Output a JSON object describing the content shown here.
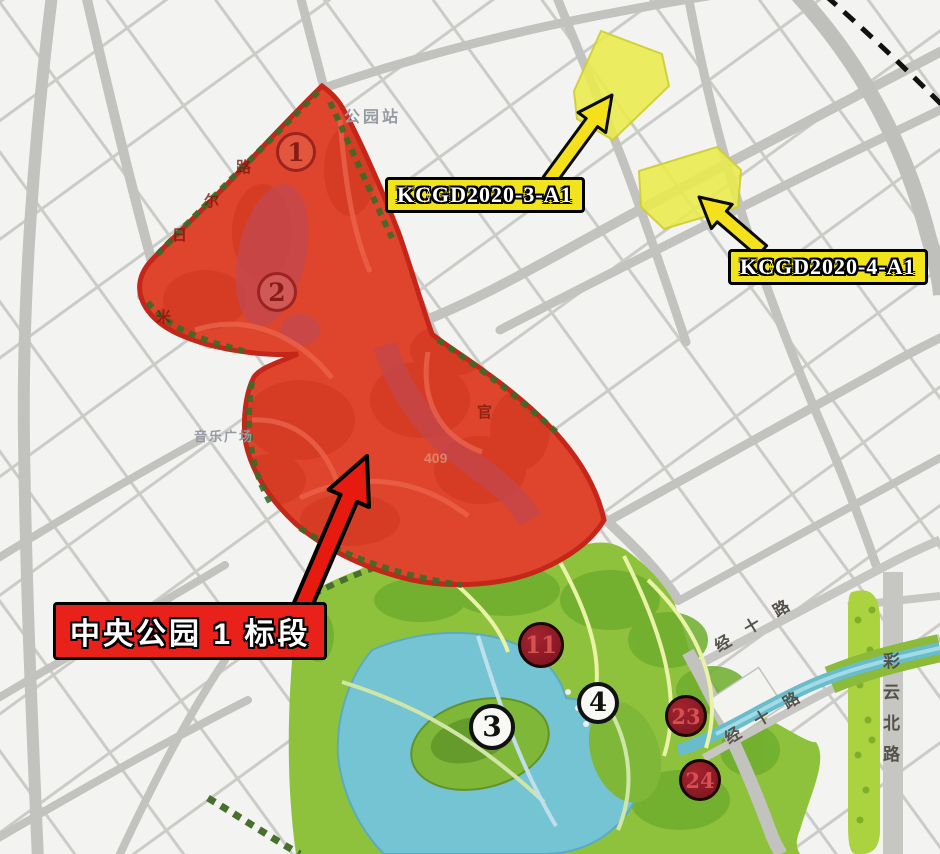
{
  "labels": {
    "park_section": "中央公园 1 标段",
    "parcel_3": "KCGD2020-3-A1",
    "parcel_4": "KCGD2020-4-A1"
  },
  "markers": [
    {
      "id": "zone-1",
      "label": "1"
    },
    {
      "id": "zone-2",
      "label": "2"
    },
    {
      "id": "lake-island-3",
      "label": "3"
    },
    {
      "id": "park-4",
      "label": "4"
    },
    {
      "id": "park-11",
      "label": "11"
    },
    {
      "id": "park-23",
      "label": "23"
    },
    {
      "id": "park-24",
      "label": "24"
    }
  ],
  "road_labels": {
    "caiyun_north_road": "彩云北路",
    "jingshi_road_1": "经十路",
    "jingshi_road_2": "经十路"
  },
  "map_texts": {
    "park_station": "公园站",
    "music_plaza": "音乐广场",
    "faint_char_1": "路",
    "faint_char_2": "尔",
    "faint_char_3": "日",
    "faint_char_4": "米",
    "faint_char_5": "官",
    "faint_number": "409"
  },
  "colors": {
    "zone_overlay_red": "#e5301f",
    "zone_border_red": "#c5261a",
    "callout_red_bg": "#e8211a",
    "callout_yellow_bg": "#f2e41c",
    "parcel_fill_yellow": "#e9eb4b",
    "park_green": "#8fc23c",
    "lake_teal": "#74c4d3",
    "marker_dark_red": "#8e1b24",
    "road_gray": "#c6c6c2"
  }
}
